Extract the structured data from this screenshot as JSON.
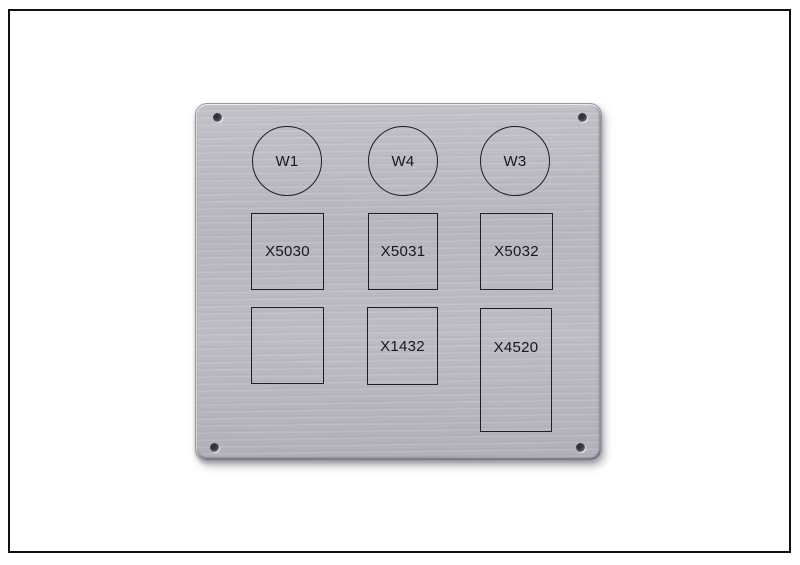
{
  "scene": {
    "description": "Photo of a brushed aluminium front panel with engraved cutout markings, mounted look with four corner screw holes, inside a thin black picture frame on white",
    "colors": {
      "background": "#ffffff",
      "frame_border": "#111114",
      "metal_base": "#b9b8c0",
      "metal_light": "#c7c6cc",
      "metal_dark": "#aeadb5",
      "outline": "#1e1e27",
      "text": "#17171f",
      "screw_hole_dark": "#2c2b33"
    }
  },
  "panel": {
    "circles": [
      {
        "label": "W1"
      },
      {
        "label": "W4"
      },
      {
        "label": "W3"
      }
    ],
    "row1": [
      {
        "label": "X5030"
      },
      {
        "label": "X5031"
      },
      {
        "label": "X5032"
      }
    ],
    "row2": [
      {
        "label": ""
      },
      {
        "label": "X1432"
      },
      {
        "label": "X4520"
      }
    ],
    "screw_hole_count": "4"
  }
}
